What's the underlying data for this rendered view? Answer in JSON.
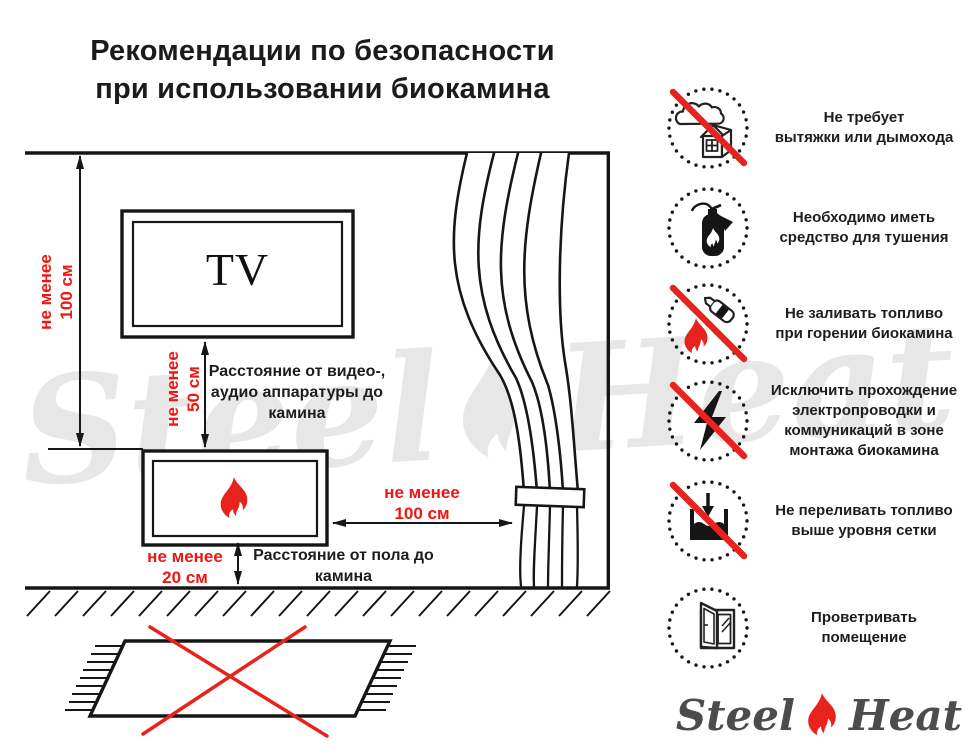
{
  "title": {
    "text": "Рекомендации по безопасности\nпри использовании биокамина"
  },
  "diagram": {
    "tv_label": "TV",
    "wall_dim": "не менее\n100 см",
    "tv_dim": "не менее\n50 см",
    "tv_caption": "Расстояние от видео-,\nаудио аппаратуры до\nкамина",
    "curtain_dim": "не менее\n100 см",
    "floor_dim": "не менее\n20 см",
    "floor_caption": "Расстояние от пола до\nкамина"
  },
  "rules": [
    {
      "icon": "no-chimney-icon",
      "crossed": true,
      "text": "Не требует\nвытяжки или дымохода"
    },
    {
      "icon": "extinguisher-icon",
      "crossed": false,
      "text": "Необходимо иметь\nсредство для тушения"
    },
    {
      "icon": "no-refuel-while-burning-icon",
      "crossed": true,
      "text": "Не заливать топливо\nпри горении биокамина"
    },
    {
      "icon": "no-electrical-wiring-icon",
      "crossed": true,
      "text": "Исключить прохождение\nэлектропроводки и\nкоммуникаций в зоне\nмонтажа биокамина"
    },
    {
      "icon": "no-overfill-icon",
      "crossed": true,
      "text": "Не переливать топливо\nвыше уровня сетки"
    },
    {
      "icon": "ventilate-room-icon",
      "crossed": false,
      "text": "Проветривать\nпомещение"
    }
  ],
  "watermark": {
    "left": "Steel",
    "right": "Heat"
  },
  "logo": {
    "left": "Steel",
    "right": "Heat"
  },
  "colors": {
    "red": "#e8231e",
    "red_text": "#ee1512",
    "ink": "#161616",
    "watermark_gray": "#e7e7e7",
    "logo_gray": "#4c4c4c"
  }
}
